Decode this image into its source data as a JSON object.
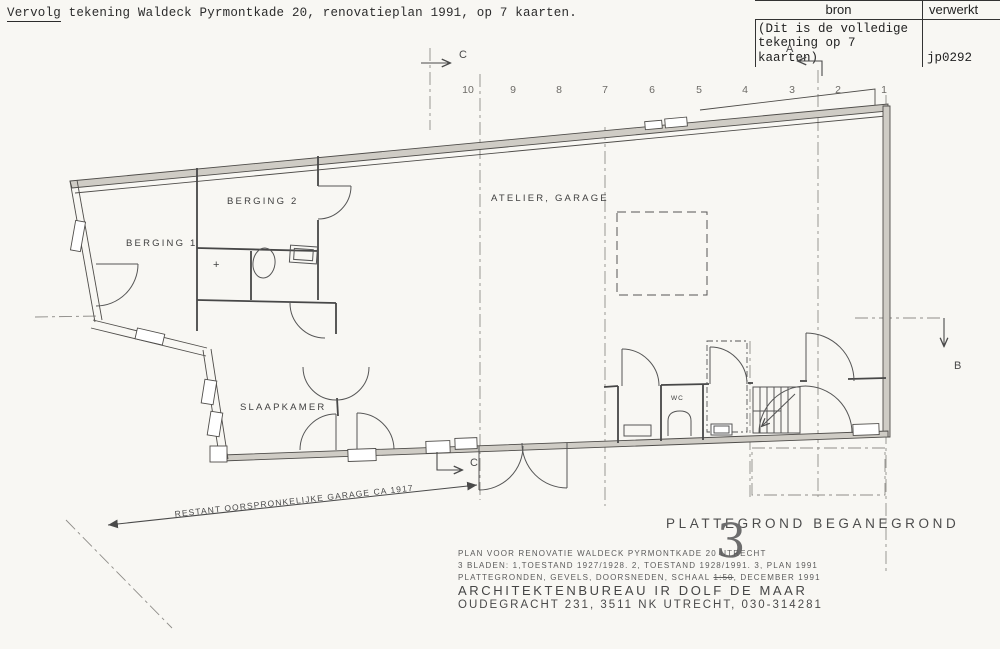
{
  "page": {
    "paper_color": "#f8f7f3",
    "ink_color": "#3f3f3f",
    "wall_fill_color": "#cfccc5"
  },
  "header": {
    "underlined_word": "Vervolg",
    "rest": " tekening Waldeck Pyrmontkade 20, renovatieplan 1991, op 7 kaarten."
  },
  "stamp_table": {
    "col_source": "bron",
    "col_processed": "verwerkt",
    "source_line1": "(Dit is de volledige",
    "source_line2": "tekening op 7 kaarten)",
    "processed_value": "jp0292"
  },
  "plan": {
    "grid_labels": [
      "10",
      "9",
      "8",
      "7",
      "6",
      "5",
      "4",
      "3",
      "2",
      "1"
    ],
    "section_markers": {
      "a": "A",
      "b": "B",
      "c_top": "C",
      "c_bottom": "C"
    },
    "rooms": {
      "berging1": "BERGING 1",
      "berging2": "BERGING 2",
      "atelier": "ATELIER, GARAGE",
      "slaapkamer": "SLAAPKAMER",
      "wc": "WC"
    },
    "plus_mark": "+",
    "dimension_note": "RESTANT OORSPRONKELIJKE GARAGE CA 1917"
  },
  "title_block": {
    "title": "PLATTEGROND BEGANEGROND",
    "sheet_number": "3",
    "line1": "PLAN VOOR RENOVATIE WALDECK PYRMONTKADE 20 UTRECHT",
    "line2": "3 BLADEN: 1,TOESTAND 1927/1928. 2, TOESTAND 1928/1991. 3, PLAN 1991",
    "line3_prefix": "PLATTEGRONDEN, GEVELS, DOORSNEDEN, SCHAAL ",
    "line3_struck": "1:50",
    "line3_suffix": ", DECEMBER 1991",
    "line4": "ARCHITEKTENBUREAU IR DOLF DE MAAR",
    "line5": "OUDEGRACHT 231, 3511 NK UTRECHT, 030-314281"
  }
}
